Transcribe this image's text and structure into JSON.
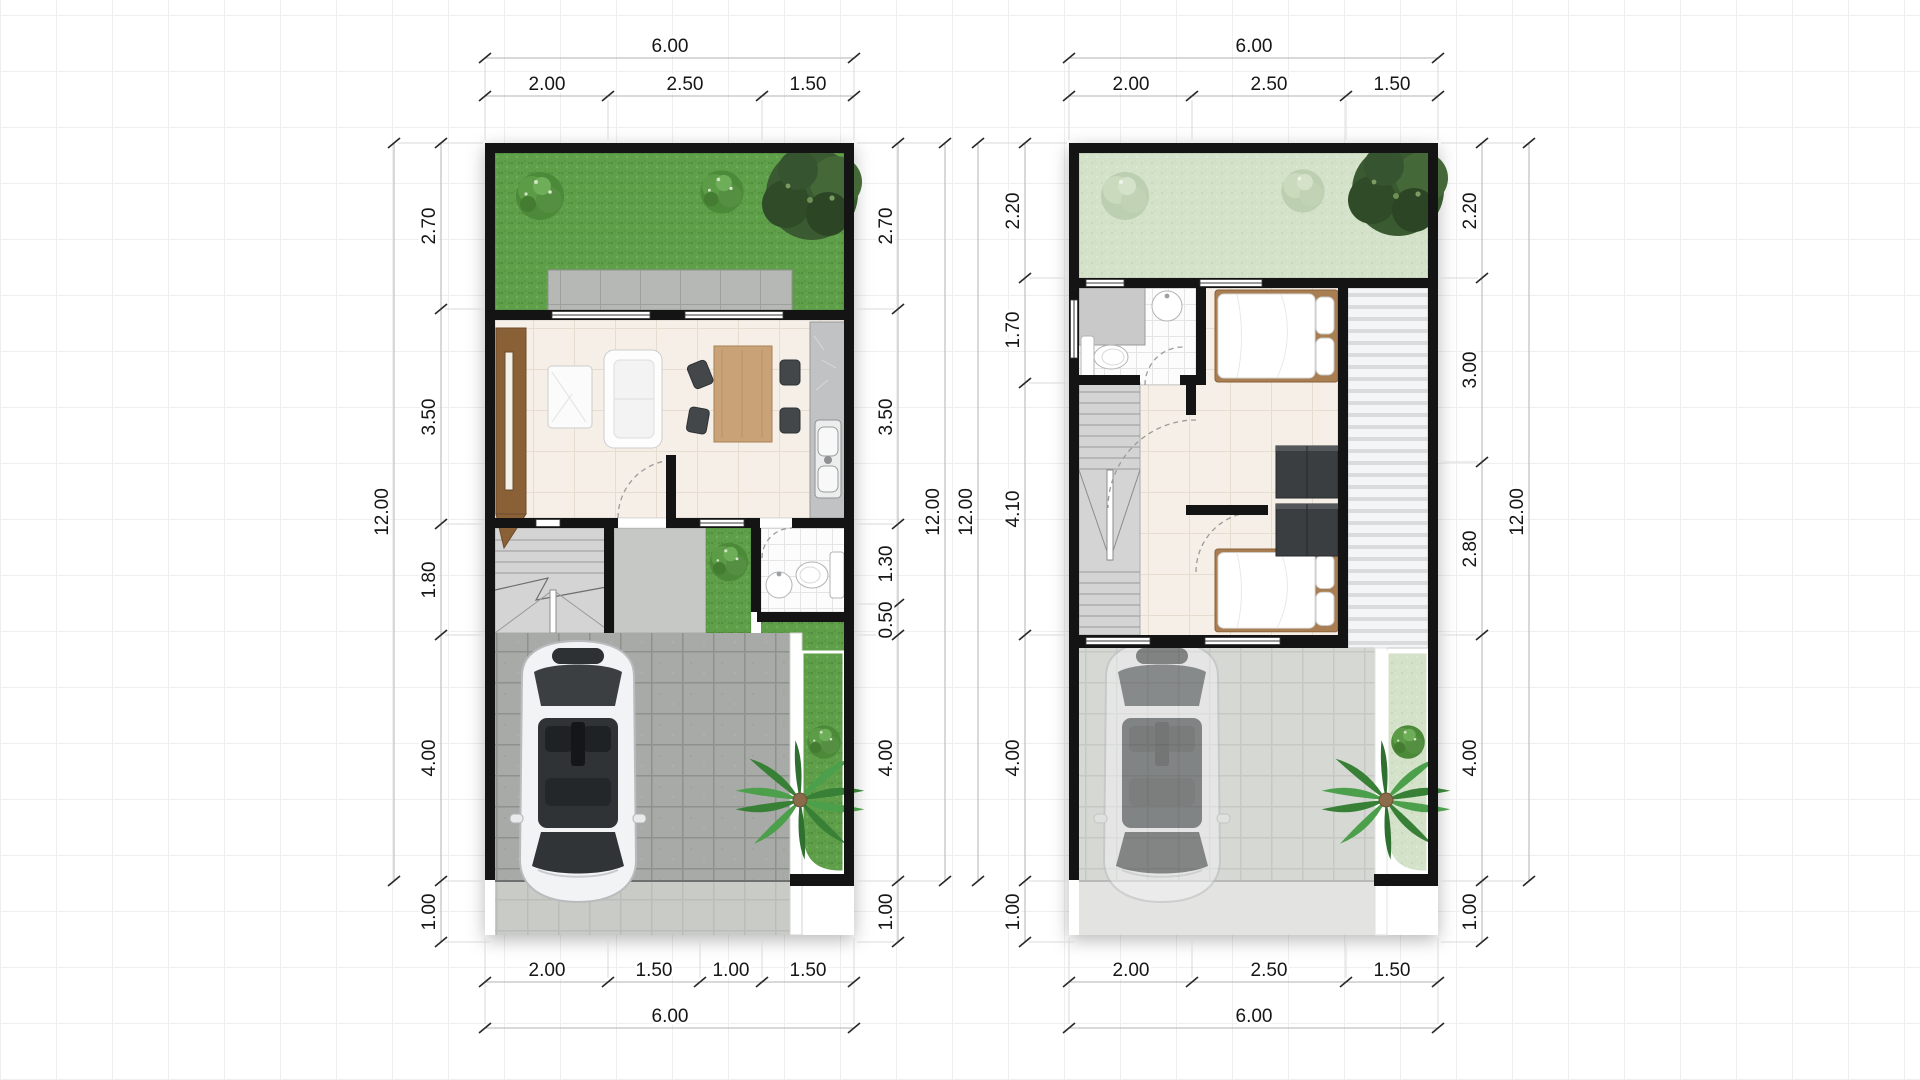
{
  "plans": [
    {
      "name": "ground-floor-plan",
      "dims": {
        "top_total": "6.00",
        "top_segments": [
          "2.00",
          "2.50",
          "1.50"
        ],
        "left_outer": "12.00",
        "left_segments": [
          "2.70",
          "3.50",
          "1.80",
          "4.00",
          "1.00"
        ],
        "right_segments": [
          "2.70",
          "3.50",
          "1.30",
          "0.50",
          "4.00",
          "1.00"
        ],
        "right_outer": "12.00",
        "bottom_segments": [
          "2.00",
          "1.50",
          "1.00",
          "1.50"
        ],
        "bottom_total": "6.00"
      }
    },
    {
      "name": "upper-floor-plan",
      "dims": {
        "top_total": "6.00",
        "top_segments": [
          "2.00",
          "2.50",
          "1.50"
        ],
        "left_outer": "12.00",
        "left_segments": [
          "2.20",
          "1.70",
          "4.10",
          "4.00",
          "1.00"
        ],
        "right_segments": [
          "2.20",
          "3.00",
          "2.80",
          "4.00",
          "1.00"
        ],
        "right_outer": "12.00",
        "bottom_segments": [
          "2.00",
          "2.50",
          "1.50"
        ],
        "bottom_total": "6.00"
      }
    }
  ],
  "colors": {
    "wall": "#141414",
    "grass": "#5f9f49",
    "grass_faded": "#d4e2ca",
    "pavers": "#a7aaa6",
    "floor_cream": "#f5efe7",
    "wood": "#c9a278",
    "dark_furniture": "#3a3e41",
    "dim_text": "#161616"
  }
}
